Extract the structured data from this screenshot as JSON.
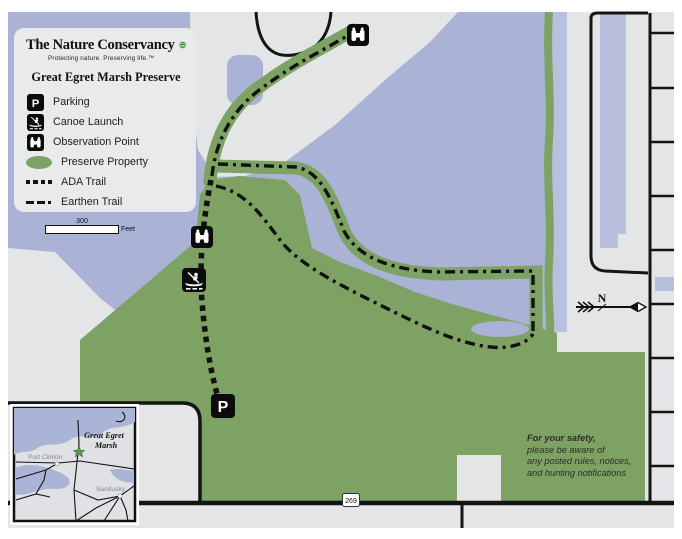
{
  "legend": {
    "org_name": "The Nature Conservancy",
    "org_tagline": "Protecting nature. Preserving life.™",
    "title": "Great Egret Marsh Preserve",
    "items": [
      {
        "icon": "parking-icon",
        "label": "Parking"
      },
      {
        "icon": "canoe-launch-icon",
        "label": "Canoe Launch"
      },
      {
        "icon": "observation-point-icon",
        "label": "Observation Point"
      },
      {
        "icon": "preserve-property-swatch",
        "label": "Preserve Property"
      },
      {
        "icon": "ada-trail-sample",
        "label": "ADA Trail"
      },
      {
        "icon": "earthen-trail-sample",
        "label": "Earthen Trail"
      }
    ]
  },
  "scale_bar": {
    "value": "300",
    "unit": "Feet"
  },
  "compass": {
    "label": "N"
  },
  "roads": {
    "main_road_label": "N. Buck Rd.",
    "route_shield": "269"
  },
  "markers": {
    "parking_letter": "P"
  },
  "safety": {
    "heading": "For your safety,",
    "lines": [
      "please be aware of",
      "any posted rules, notices,",
      "and hunting notifications"
    ]
  },
  "inset": {
    "place_line1": "Great Egret",
    "place_line2": "Marsh",
    "cities": [
      "Port Clinton",
      "Sandusky"
    ]
  },
  "colors": {
    "water": "#aab3d5",
    "water_light": "#b8c0dd",
    "land": "#e4e5e7",
    "preserve_green": "#7da263",
    "legend_bg": "#e9eaec",
    "road_black": "#141414",
    "logo_green": "#3f9c35",
    "star_green": "#57a83c"
  }
}
